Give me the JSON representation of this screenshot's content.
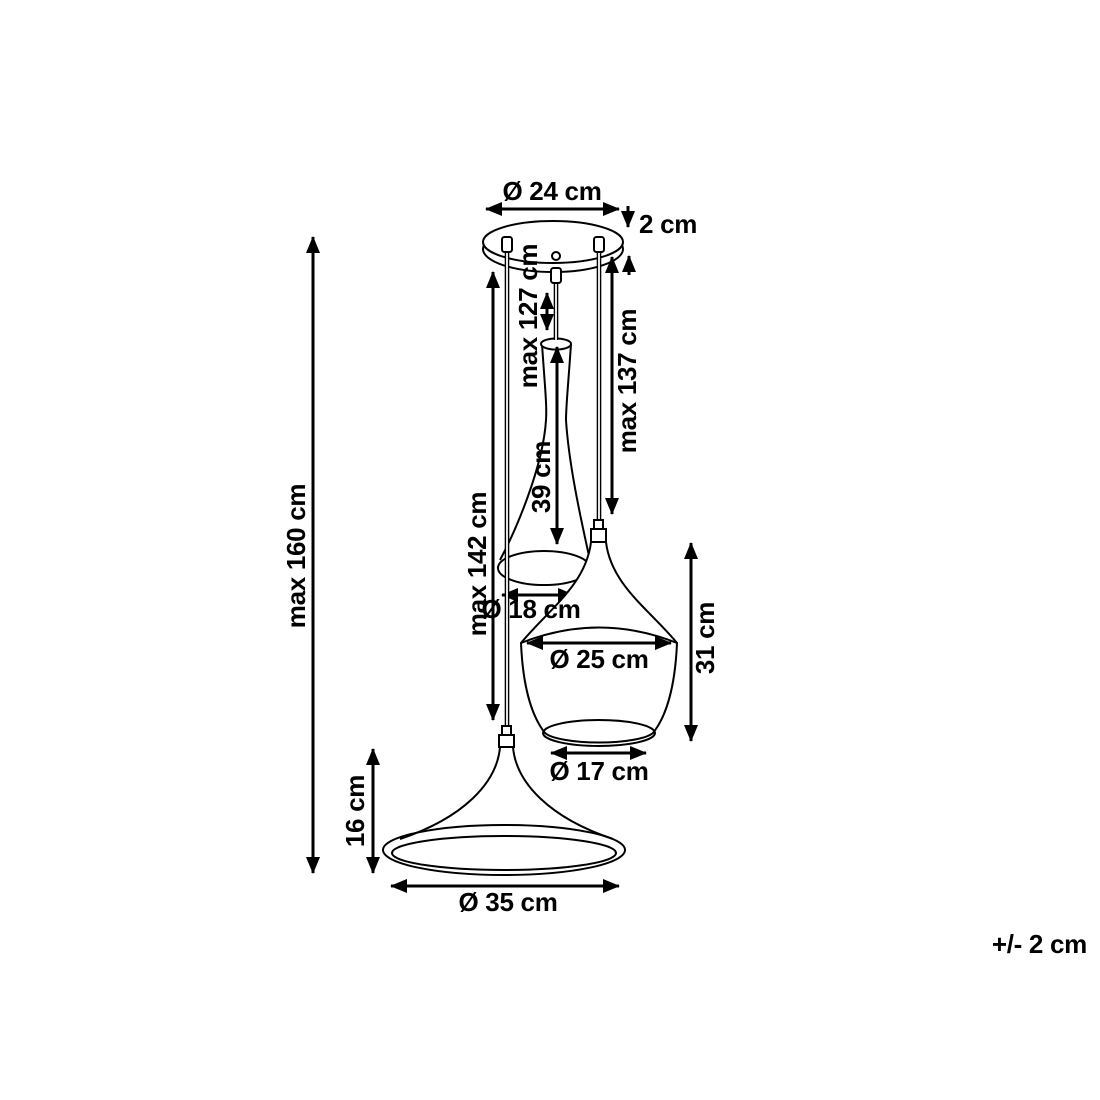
{
  "meta": {
    "background": "#ffffff",
    "line_color": "#000000"
  },
  "labels": {
    "canopy_diameter": "Ø 24 cm",
    "canopy_height": "2 cm",
    "overall_height": "max 160 cm",
    "tall_shade_drop": "max 127 cm",
    "fat_shade_drop": "max 137 cm",
    "wide_shade_drop": "max 142 cm",
    "tall_shade_height": "39 cm",
    "tall_shade_opening": "Ø 18 cm",
    "fat_shade_diameter": "Ø 25 cm",
    "fat_shade_height": "31 cm",
    "fat_shade_opening": "Ø 17 cm",
    "wide_shade_height": "16 cm",
    "wide_shade_diameter": "Ø 35 cm",
    "tolerance": "+/- 2 cm"
  }
}
